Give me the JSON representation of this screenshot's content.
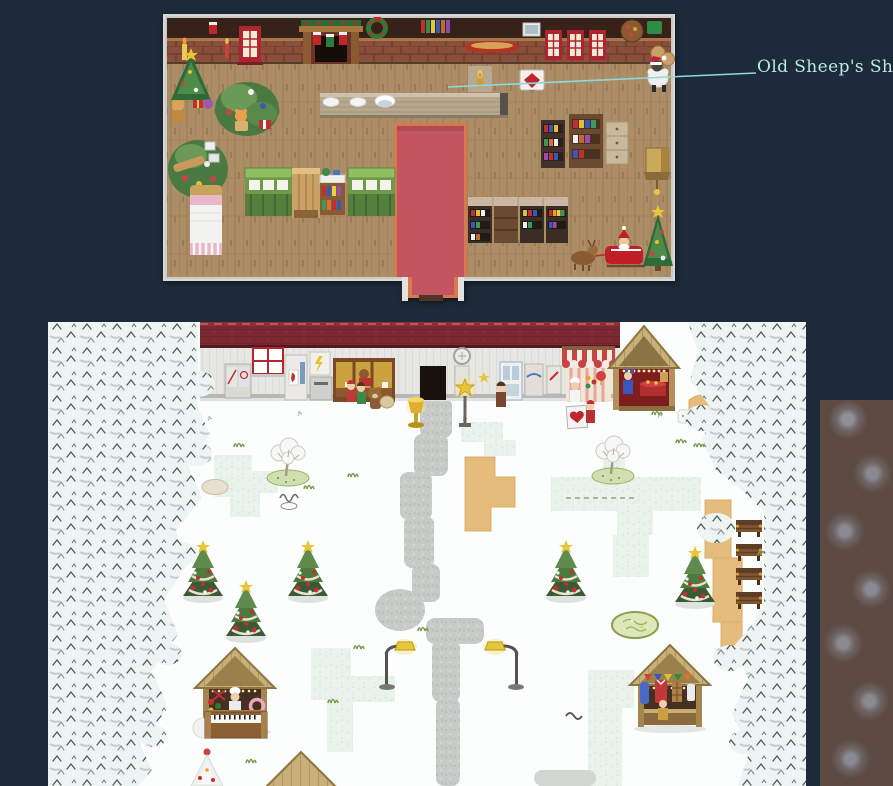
{
  "page": {
    "background": "#1d2a39"
  },
  "annotation": {
    "label": "Old Sheep's Shop",
    "color": "#b9e9e5",
    "line_color": "#8fd8dc"
  },
  "maps": {
    "interior": {
      "name": "old-sheeps-shop-interior-map",
      "frame_color": "#d8d8d6",
      "floor_color": "#ad8d66",
      "wall_color": "#43291f",
      "carpet_color": "#c25560",
      "carpet_border_color": "#d97a4c",
      "features": [
        "christmas-trees",
        "gift-piles",
        "fireplace-with-stockings",
        "wreath",
        "red-windows",
        "counter-with-plates",
        "red-carpet",
        "green-market-stalls",
        "bed",
        "bookshelves",
        "santa-sleigh-with-reindeer",
        "sheep-npc",
        "gem-sign",
        "hanging-shop-sign"
      ]
    },
    "village": {
      "name": "snowy-village-map",
      "snow_color": "#fcfdfd",
      "roof_color": "#7b2832",
      "siding_color": "#e6e6e3",
      "hedge_color": "#e9f3ec",
      "path_color": "#c7cac7",
      "sand_color": "#e6bc7d",
      "features": [
        "shop-building-row",
        "lit-shop-counter",
        "striped-awning-shop",
        "gold-wooden-stall",
        "pine-forest-left",
        "pine-forest-right",
        "snow-hedges",
        "gravel-path",
        "sand-patches",
        "decorated-christmas-trees",
        "bare-winter-trees",
        "market-stalls",
        "piano-stall",
        "street-lamps",
        "benches",
        "garden-circle",
        "npc-characters"
      ]
    },
    "side_panel": {
      "color": "#5c4a43"
    }
  }
}
